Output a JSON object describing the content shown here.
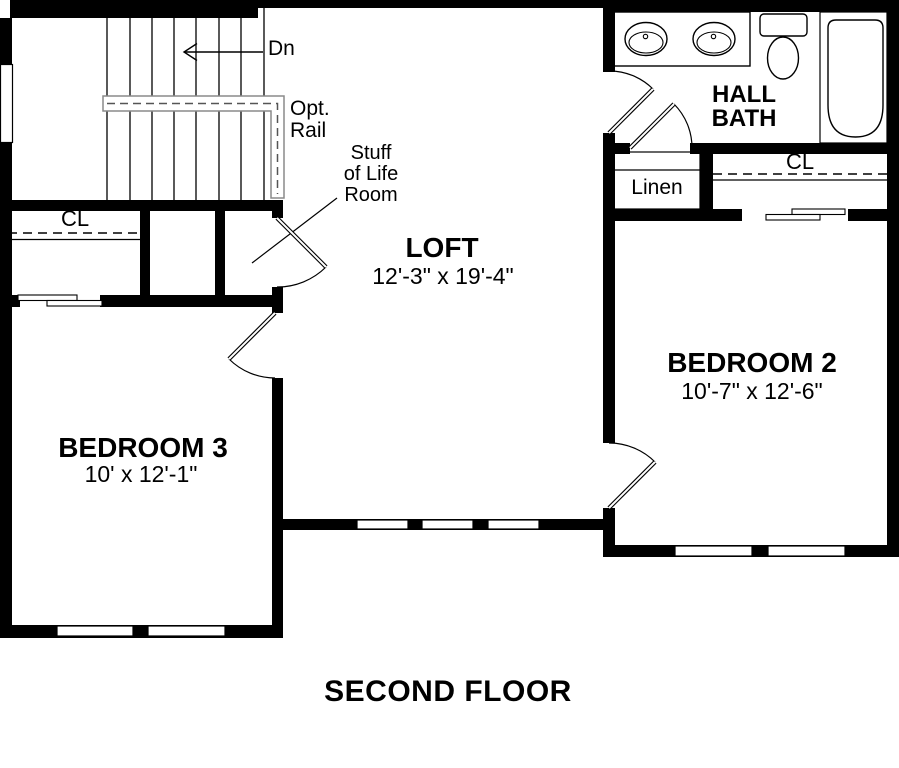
{
  "floor_title": "SECOND FLOOR",
  "stairs": {
    "direction_label": "Dn",
    "rail_label_line1": "Opt.",
    "rail_label_line2": "Rail"
  },
  "rooms": {
    "loft": {
      "name": "LOFT",
      "dimensions": "12'-3\" x 19'-4\""
    },
    "bedroom_2": {
      "name": "BEDROOM 2",
      "dimensions": "10'-7\" x 12'-6\""
    },
    "bedroom_3": {
      "name": "BEDROOM 3",
      "dimensions": "10' x 12'-1\""
    },
    "hall_bath": {
      "name_line1": "HALL",
      "name_line2": "BATH"
    },
    "stuff_of_life_room": {
      "label_line1": "Stuff",
      "label_line2": "of Life",
      "label_line3": "Room"
    },
    "linen_closet": {
      "name": "Linen"
    },
    "bedroom_2_closet": {
      "label": "CL"
    },
    "bedroom_3_closet": {
      "label": "CL"
    }
  },
  "colors": {
    "wall": "#000000",
    "background": "#ffffff",
    "rail_outline": "#8a8a8a",
    "text": "#000000"
  }
}
